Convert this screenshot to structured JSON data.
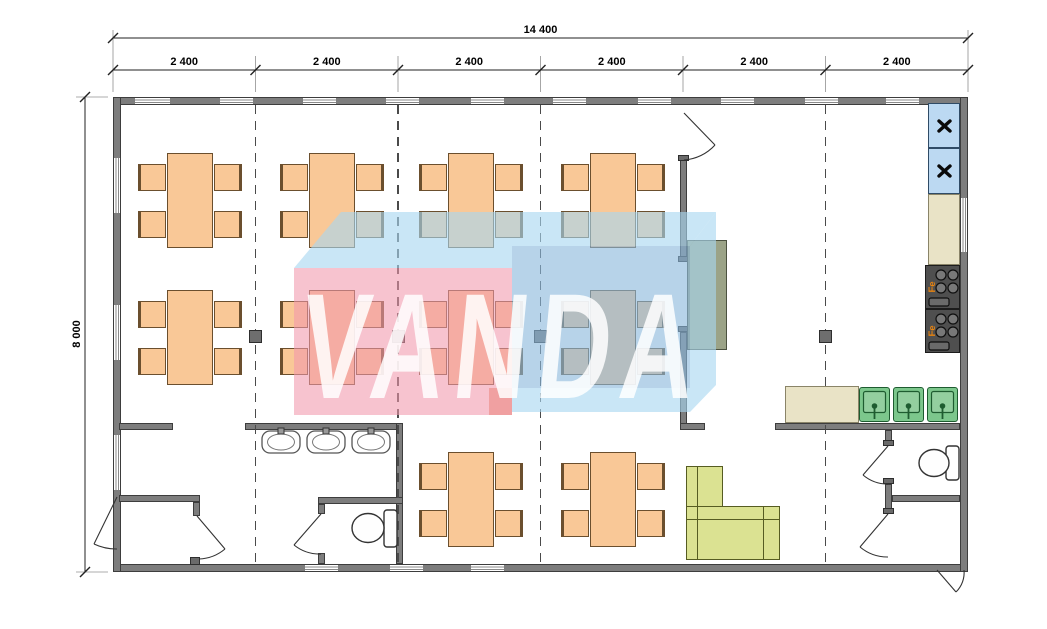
{
  "drawing": {
    "kind": "modular building floor plan",
    "modules_across": 6,
    "contents": {
      "dining_tables": 10,
      "chairs_per_table": 4,
      "washbasins": 3,
      "toilets": 2,
      "kitchen_sinks": 3,
      "stoves": 2,
      "fridges": 2,
      "sofas": 1
    }
  },
  "dimensions": {
    "overall_width": "14 400",
    "overall_height": "8 000",
    "modules": [
      "2 400",
      "2 400",
      "2 400",
      "2 400",
      "2 400",
      "2 400"
    ]
  },
  "watermark": {
    "text": "VANDA"
  },
  "kitchen": {
    "stove_label": "Fe"
  },
  "icons": {
    "fridge_icon": "x-mark",
    "door_icon": "quarter-arc-swing"
  },
  "colors": {
    "wall": "#7d7d7d",
    "furniture_wood": "#f9c897",
    "sofa_green": "#dbe292",
    "sink_green": "#7cc78c",
    "fridge_blue": "#bcd9f2",
    "counter_beige": "#e9e3c6",
    "stove_dark": "#4f4f4f",
    "stove_label_orange": "#e8830f",
    "watermark_pink": "#f298ac",
    "watermark_blue": "#8ab8dc",
    "watermark_bevel": "#a8d6f0"
  }
}
